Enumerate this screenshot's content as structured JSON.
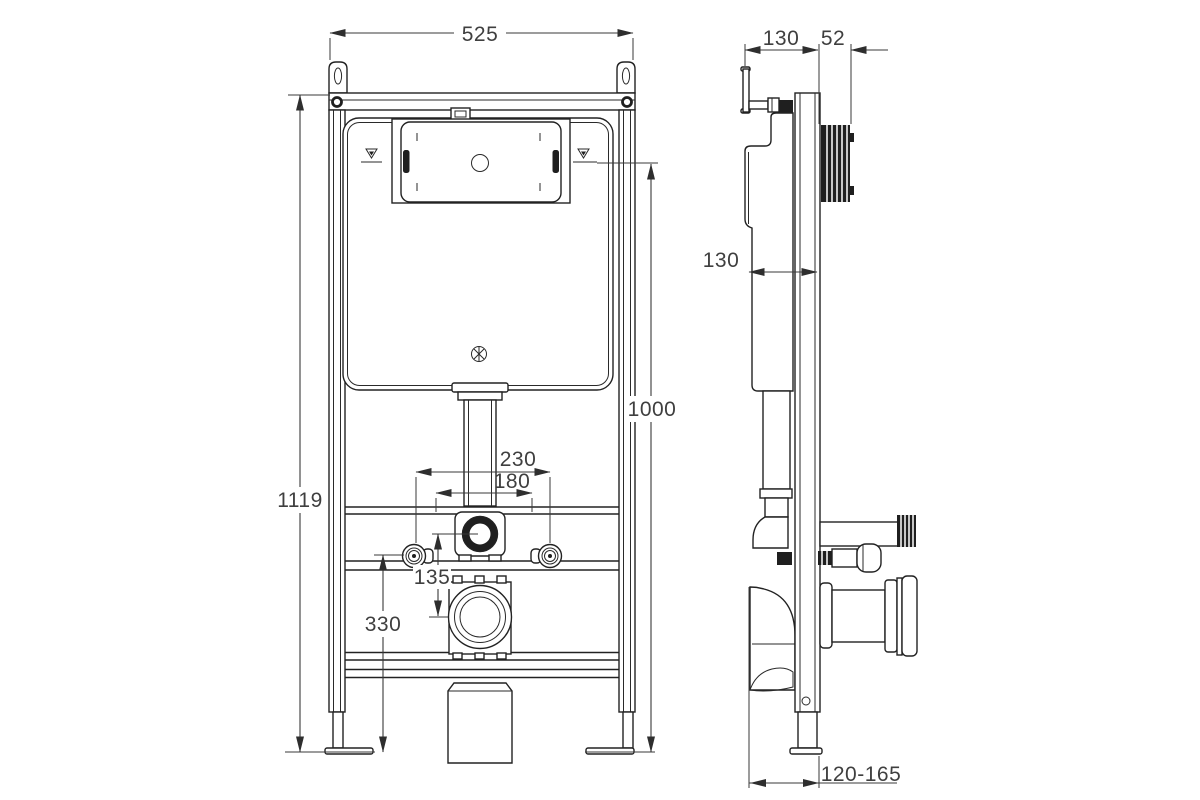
{
  "meta": {
    "type": "technical-drawing",
    "views": [
      "front",
      "side"
    ]
  },
  "colors": {
    "background": "#ffffff",
    "line": "#222222",
    "dimension_text": "#3f3f3f"
  },
  "symbols": {
    "water_level_left": "water-level-mark",
    "water_level_right": "water-level-mark"
  },
  "dims": {
    "front_width": "525",
    "front_total_height": "1119",
    "front_flush_height": "1000",
    "front_fixing_outer": "230",
    "front_fixing_inner": "180",
    "front_flush_outlet": "135",
    "front_outlet_height": "330",
    "side_top_depth": "130",
    "side_actuator_depth": "52",
    "side_cistern_depth": "130",
    "side_floor_range": "120-165"
  }
}
